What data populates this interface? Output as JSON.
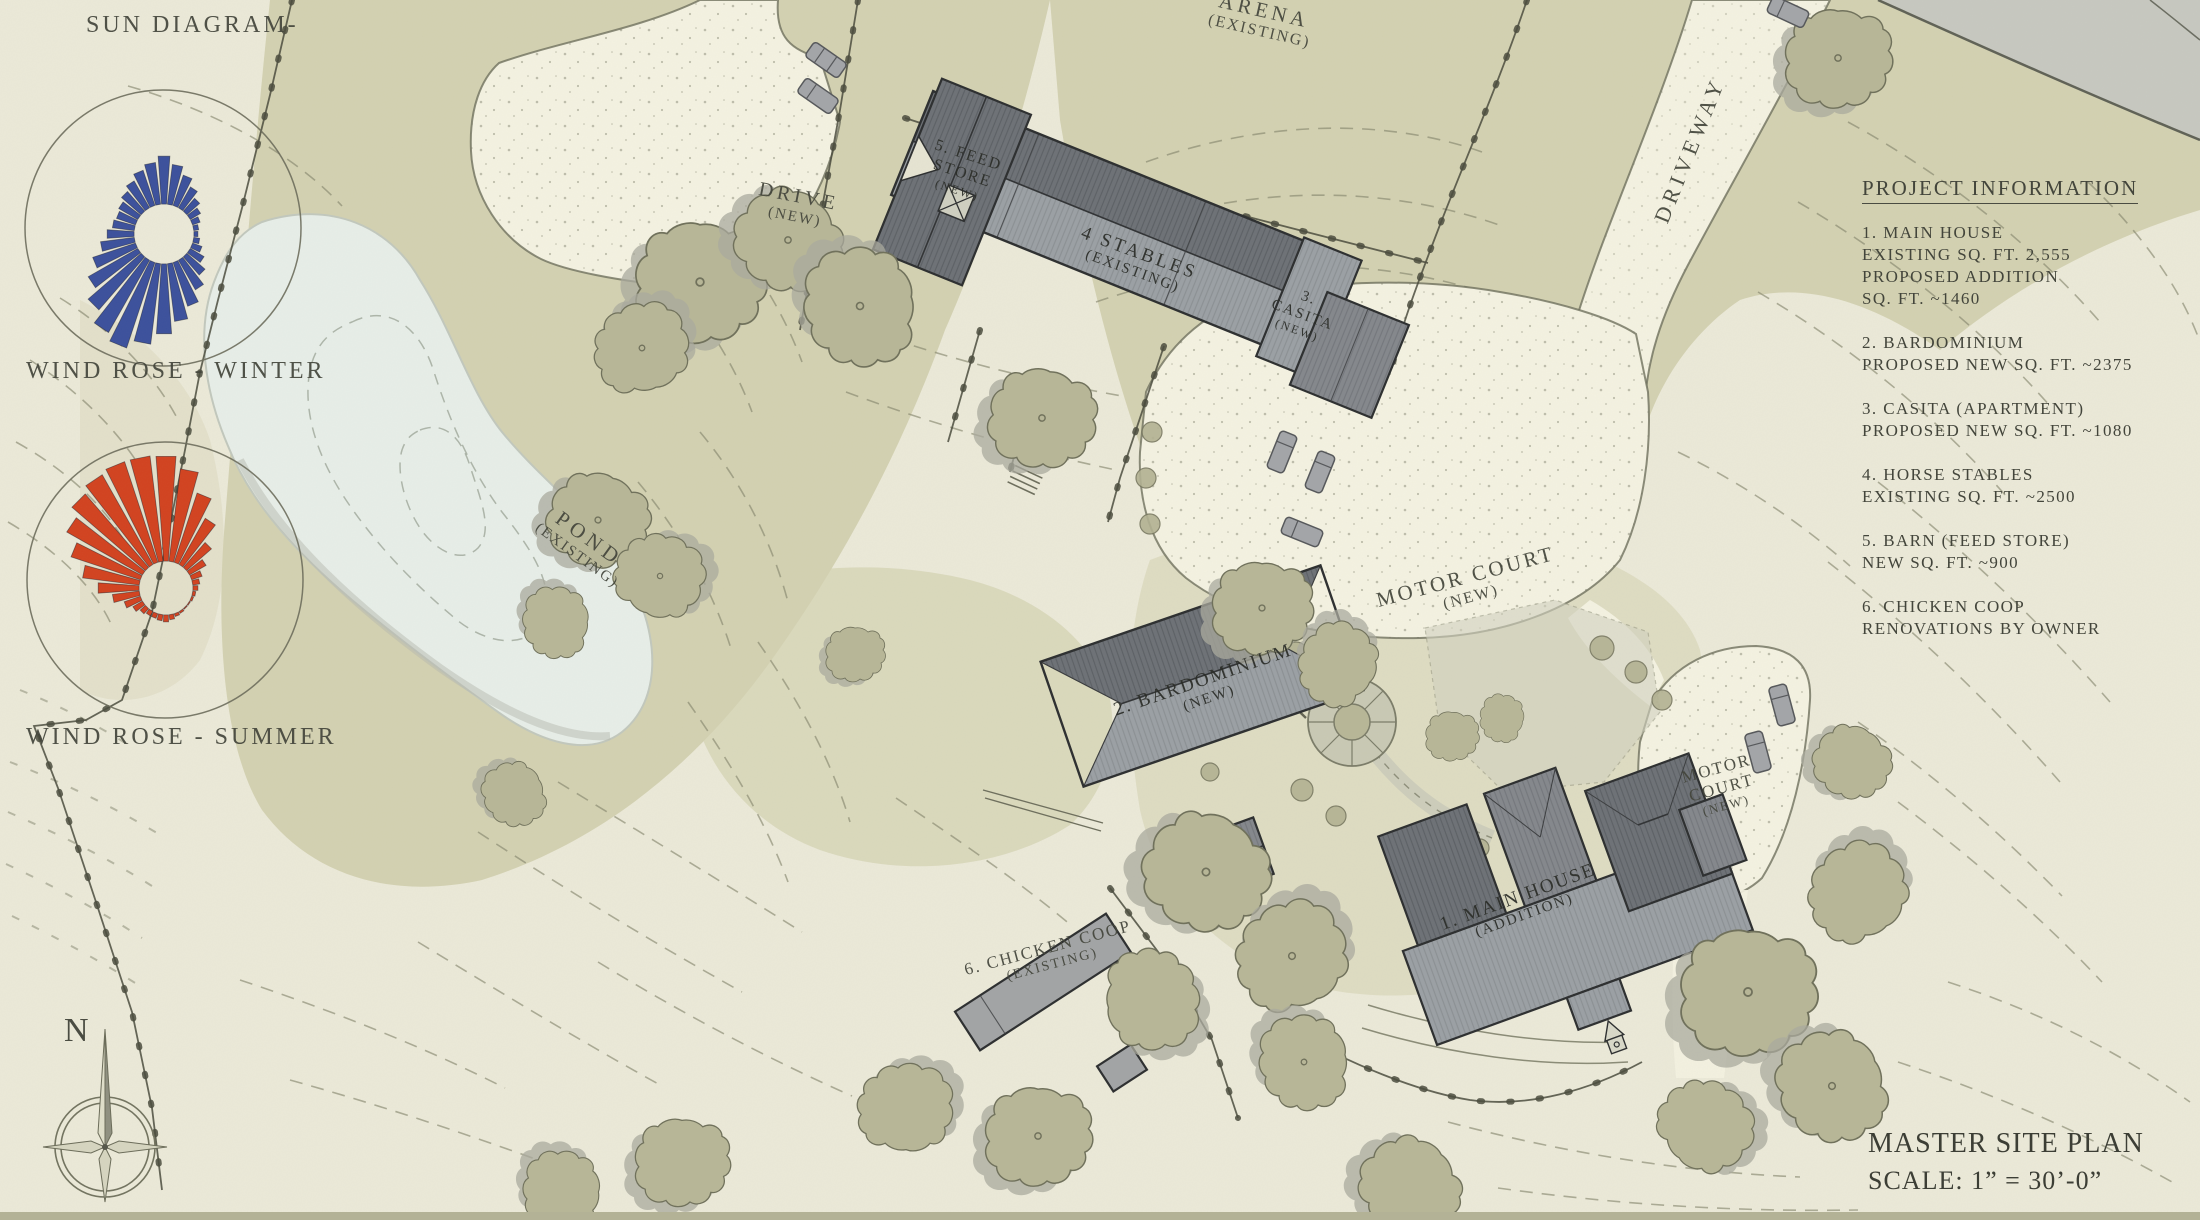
{
  "page": {
    "title": "MASTER SITE PLAN",
    "scale": "SCALE: 1” = 30’-0”"
  },
  "diagrams": {
    "sun_diagram_label": "SUN DIAGRAM-",
    "wind_rose_winter_label": "WIND ROSE - WINTER",
    "wind_rose_summer_label": "WIND ROSE - SUMMER",
    "north_label": "N",
    "wind_roses": {
      "winter": {
        "color": "#3b509c",
        "hole_radius": 30,
        "ring_radius": 138,
        "petal_lengths": [
          78,
          70,
          62,
          54,
          47,
          42,
          38,
          35,
          34,
          36,
          40,
          46,
          54,
          64,
          76,
          88,
          100,
          111,
          120,
          113,
          100,
          87,
          75,
          64,
          57,
          52,
          50,
          52,
          56,
          61,
          67,
          72
        ]
      },
      "summer": {
        "color": "#d2421f",
        "hole_radius": 27,
        "ring_radius": 138,
        "petal_lengths": [
          132,
          120,
          100,
          80,
          60,
          46,
          38,
          34,
          32,
          30,
          29,
          28,
          28,
          29,
          30,
          32,
          34,
          33,
          32,
          32,
          34,
          38,
          44,
          54,
          68,
          84,
          100,
          114,
          124,
          130,
          133,
          133
        ]
      }
    }
  },
  "project_info": {
    "heading": "PROJECT INFORMATION",
    "items": [
      {
        "lines": [
          "1. MAIN HOUSE",
          "EXISTING SQ. FT. 2,555",
          "PROPOSED ADDITION",
          "SQ. FT. ~1460"
        ]
      },
      {
        "lines": [
          "2. BARDOMINIUM",
          "PROPOSED NEW SQ. FT. ~2375"
        ]
      },
      {
        "lines": [
          "3. CASITA (APARTMENT)",
          "PROPOSED NEW SQ. FT. ~1080"
        ]
      },
      {
        "lines": [
          "4. HORSE STABLES",
          "EXISTING SQ. FT. ~2500"
        ]
      },
      {
        "lines": [
          "5. BARN (FEED STORE)",
          "NEW SQ. FT. ~900"
        ]
      },
      {
        "lines": [
          "6. CHICKEN COOP",
          "RENOVATIONS BY OWNER"
        ]
      }
    ]
  },
  "map_labels": {
    "arena_name": "ARENA",
    "arena_status": "(EXISTING)",
    "drive_name": "DRIVE",
    "drive_status": "(NEW)",
    "driveway": "DRIVEWAY",
    "pond_name": "POND",
    "pond_status": "(EXISTING)",
    "feed_store_l1": "5. FEED",
    "feed_store_l2": "STORE",
    "feed_store_l3": "(NEW)",
    "stables_name": "4 STABLES",
    "stables_status": "(EXISTING)",
    "casita_l1": "3.",
    "casita_l2": "CASITA",
    "casita_l3": "(NEW)",
    "motor_court_name": "MOTOR COURT",
    "motor_court_status": "(NEW)",
    "bardominium_name": "2. BARDOMINIUM",
    "bardominium_status": "(NEW)",
    "main_house_name": "1. MAIN HOUSE",
    "main_house_status": "(ADDITION)",
    "motor_court_east_l1": "MOTOR",
    "motor_court_east_l2": "COURT",
    "motor_court_east_l3": "(NEW)",
    "chicken_coop_name": "6. CHICKEN COOP",
    "chicken_coop_status": "(EXISTING)"
  },
  "colors": {
    "paper": "#ebe9d8",
    "terrain_olive": "#d3d1b1",
    "pond": "#e7eee8",
    "road": "#f4f2e1",
    "road_gray": "#c7c8c0",
    "roof_dark": "#6d7176",
    "roof_mid": "#84878c",
    "roof_light": "#9ba0a4",
    "contour": "#82836b",
    "text": "#43453b",
    "wind_winter": "#3b509c",
    "wind_summer": "#d2421f",
    "tree": "#b7b697",
    "shadow": "#a9a99d"
  }
}
